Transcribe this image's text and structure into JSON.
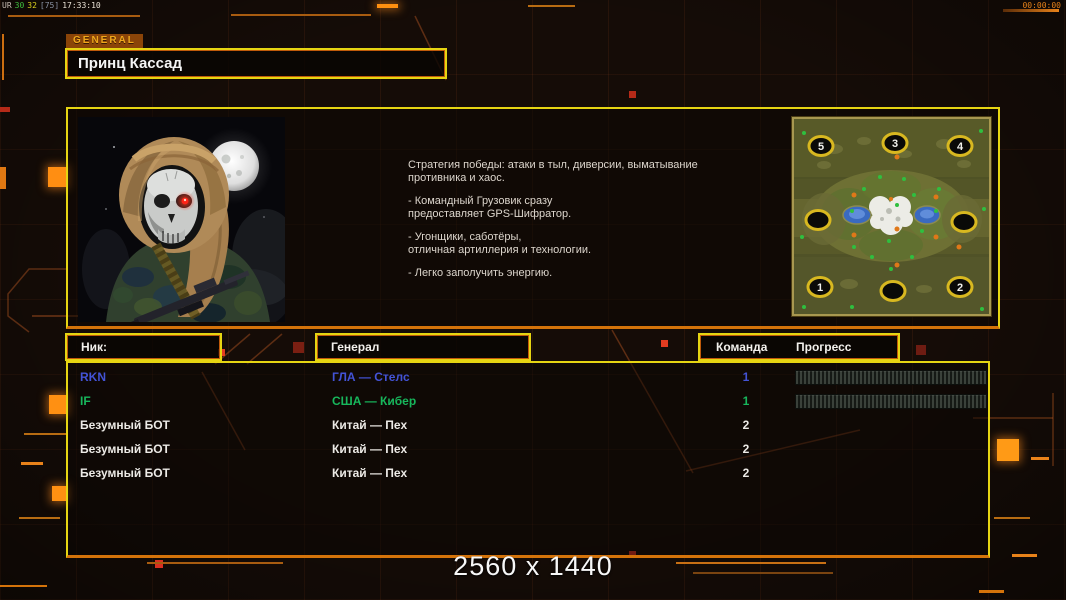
{
  "hud": {
    "top_left_parts": [
      {
        "text": "UR",
        "color": "#c8beb4"
      },
      {
        "text": "30",
        "color": "#3fbf3f"
      },
      {
        "text": "32",
        "color": "#d9cf1e"
      },
      {
        "text": "[75]",
        "color": "#8a92a2"
      },
      {
        "text": "17:33:10",
        "color": "#eae2d6"
      }
    ],
    "top_right_timer": "00:00:00"
  },
  "general_tag": "GENERAL",
  "title": "Принц Кассад",
  "strategy": {
    "paragraphs": [
      {
        "lines": [
          "Стратегия победы: атаки в тыл, диверсии, выматывание",
          " противника и хаос."
        ]
      },
      {
        "lines": [
          "- Командный Грузовик сразу",
          "предоставляет GPS-Шифратор."
        ]
      },
      {
        "lines": [
          "- Угонщики, саботёры,",
          "отличная артиллерия и технологии."
        ]
      },
      {
        "lines": [
          "- Легко заполучить энергию."
        ]
      }
    ]
  },
  "minimap": {
    "markers": [
      {
        "label": "5"
      },
      {
        "label": "3"
      },
      {
        "label": "4"
      },
      {
        "label": ""
      },
      {
        "label": ""
      },
      {
        "label": "1"
      },
      {
        "label": ""
      },
      {
        "label": "2"
      }
    ]
  },
  "table": {
    "headers": {
      "nick": "Ник:",
      "general": "Генерал",
      "team": "Команда",
      "progress": "Прогресс"
    },
    "rows": [
      {
        "nick": "RKN",
        "general": "ГЛА — Стелс",
        "team": "1"
      },
      {
        "nick": "IF",
        "general": "США — Кибер",
        "team": "1"
      },
      {
        "nick": "Безумный БОТ",
        "general": "Китай — Пех",
        "team": "2"
      },
      {
        "nick": "Безумный БОТ",
        "general": "Китай — Пех",
        "team": "2"
      },
      {
        "nick": "Безумный БОТ",
        "general": "Китай — Пех",
        "team": "2"
      }
    ]
  },
  "footer_resolution": "2560 x 1440",
  "colors": {
    "panel_border_yellow": "#e6d512",
    "panel_border_orange": "#d4730a",
    "accent_bright_orange": "#ff9012",
    "accent_red": "#d93021",
    "row_blue": "#4353d6",
    "row_green": "#17b75c",
    "row_white": "#eceae6",
    "general_tag_bg": "#8a4408",
    "general_tag_text": "#f0a81c"
  }
}
